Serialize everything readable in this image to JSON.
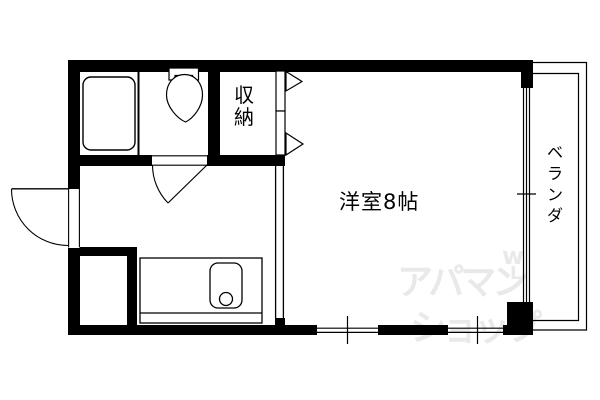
{
  "colors": {
    "background": "#ffffff",
    "line": "#000000",
    "watermark": "#e9e9e9"
  },
  "labels": {
    "storage": "収納",
    "main_room": "洋室8帖",
    "balcony": "ベランダ"
  },
  "watermark": {
    "line1": "アパマン",
    "line2": "ショップ",
    "mark1": "w",
    "mark2": "L"
  }
}
